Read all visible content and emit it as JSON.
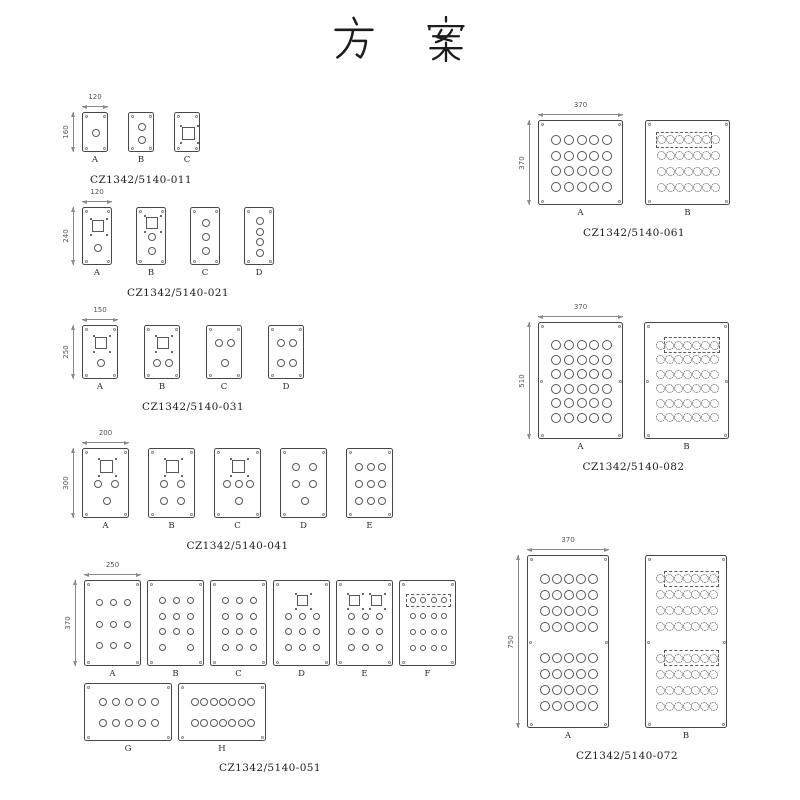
{
  "title": "方案",
  "title_chars": [
    "方",
    "案"
  ],
  "colors": {
    "line": "#474747",
    "hole": "#585858",
    "dim": "#8a8a8a",
    "text": "#1e1e1e"
  },
  "legend": {
    "o": "round-hole",
    "s": "square-cutout-with-corner-marks",
    ".": "empty-slot"
  },
  "groups": [
    {
      "code": "CZ1342/5140-011",
      "dim_w": "120",
      "dim_h": "160",
      "pos": {
        "left": 64,
        "top": 95
      },
      "pw": 26,
      "ph": 40,
      "gap": 20,
      "cs": 8,
      "sq": 13,
      "panel_rows": [
        [
          {
            "label": "A",
            "rows": [
              {
                "cells": "o"
              }
            ]
          },
          {
            "label": "B",
            "rows": [
              {
                "cells": "o"
              },
              {
                "cells": "o"
              }
            ]
          },
          {
            "label": "C",
            "rows": [
              {
                "cells": "s"
              }
            ]
          }
        ]
      ]
    },
    {
      "code": "CZ1342/5140-021",
      "dim_w": "120",
      "dim_h": "240",
      "pos": {
        "left": 64,
        "top": 190
      },
      "pw": 30,
      "ph": 58,
      "gap": 24,
      "cs": 8,
      "sq": 12,
      "panel_rows": [
        [
          {
            "label": "A",
            "rows": [
              {
                "cells": "s"
              },
              {
                "cells": "o"
              }
            ]
          },
          {
            "label": "B",
            "rows": [
              {
                "cells": "s"
              },
              {
                "cells": "o"
              },
              {
                "cells": "o"
              }
            ]
          },
          {
            "label": "C",
            "rows": [
              {
                "cells": "o"
              },
              {
                "cells": "o"
              },
              {
                "cells": "o"
              }
            ]
          },
          {
            "label": "D",
            "rows": [
              {
                "cells": "o"
              },
              {
                "cells": "o"
              },
              {
                "cells": "o"
              },
              {
                "cells": "o"
              }
            ]
          }
        ]
      ]
    },
    {
      "code": "CZ1342/5140-031",
      "dim_w": "150",
      "dim_h": "250",
      "pos": {
        "left": 64,
        "top": 308
      },
      "pw": 36,
      "ph": 54,
      "gap": 26,
      "cs": 8,
      "sq": 12,
      "panel_rows": [
        [
          {
            "label": "A",
            "rows": [
              {
                "cells": "s"
              },
              {
                "cells": "o"
              }
            ]
          },
          {
            "label": "B",
            "rows": [
              {
                "cells": "s"
              },
              {
                "cells": "oo"
              }
            ]
          },
          {
            "label": "C",
            "rows": [
              {
                "cells": "oo"
              },
              {
                "cells": "o"
              }
            ]
          },
          {
            "label": "D",
            "rows": [
              {
                "cells": "oo"
              },
              {
                "cells": "oo"
              }
            ]
          }
        ]
      ]
    },
    {
      "code": "CZ1342/5140-041",
      "dim_w": "200",
      "dim_h": "300",
      "pos": {
        "left": 64,
        "top": 431
      },
      "pw": 47,
      "ph": 70,
      "gap": 19,
      "cs": 8,
      "sq": 13,
      "panel_rows": [
        [
          {
            "label": "A",
            "rows": [
              {
                "cells": "s"
              },
              {
                "cells": "oo"
              },
              {
                "cells": "o"
              }
            ]
          },
          {
            "label": "B",
            "rows": [
              {
                "cells": "s"
              },
              {
                "cells": "oo"
              },
              {
                "cells": "oo"
              }
            ]
          },
          {
            "label": "C",
            "rows": [
              {
                "cells": "s"
              },
              {
                "cells": "ooo"
              },
              {
                "cells": "o"
              }
            ]
          },
          {
            "label": "D",
            "rows": [
              {
                "cells": "oo"
              },
              {
                "cells": "oo"
              },
              {
                "cells": "o"
              }
            ]
          },
          {
            "label": "E",
            "rows": [
              {
                "cells": "ooo"
              },
              {
                "cells": "ooo"
              },
              {
                "cells": "ooo"
              }
            ]
          }
        ]
      ]
    },
    {
      "code": "CZ1342/5140-051",
      "dim_w": "250",
      "dim_h": "370",
      "pos": {
        "left": 66,
        "top": 563
      },
      "pw": 57,
      "ph": 86,
      "gap": 6,
      "cs": 7,
      "sq": 11,
      "panel_rows": [
        [
          {
            "label": "A",
            "rows": [
              {
                "cells": "ooo"
              },
              {
                "cells": "ooo"
              },
              {
                "cells": "ooo"
              }
            ]
          },
          {
            "label": "B",
            "rows": [
              {
                "cells": "ooo"
              },
              {
                "cells": "ooo"
              },
              {
                "cells": "ooo"
              },
              {
                "cells": "o.o"
              }
            ]
          },
          {
            "label": "C",
            "rows": [
              {
                "cells": "ooo"
              },
              {
                "cells": "ooo"
              },
              {
                "cells": "ooo"
              },
              {
                "cells": "ooo"
              }
            ]
          },
          {
            "label": "D",
            "rows": [
              {
                "cells": "s"
              },
              {
                "cells": "ooo"
              },
              {
                "cells": "ooo"
              },
              {
                "cells": "ooo"
              }
            ]
          },
          {
            "label": "E",
            "rows": [
              {
                "cells": "ss"
              },
              {
                "cells": "ooo"
              },
              {
                "cells": "ooo"
              },
              {
                "cells": "ooo"
              }
            ]
          },
          {
            "label": "F",
            "cs": 6,
            "rows": [
              {
                "cells": "oooo",
                "box": [
                  0,
                  3
                ]
              },
              {
                "cells": "oooo"
              },
              {
                "cells": "oooo"
              },
              {
                "cells": "oooo"
              }
            ]
          }
        ],
        [
          {
            "label": "G",
            "w": 88,
            "h": 58,
            "cs": 8,
            "rows": [
              {
                "cells": "ooooo"
              },
              {
                "cells": "ooooo"
              }
            ]
          },
          {
            "label": "H",
            "w": 88,
            "h": 58,
            "cs": 8,
            "rows": [
              {
                "cells": "ooooooo"
              },
              {
                "cells": "ooooooo"
              }
            ]
          }
        ]
      ]
    },
    {
      "code": "CZ1342/5140-061",
      "dim_w": "370",
      "dim_h": "370",
      "pos": {
        "left": 520,
        "top": 103
      },
      "pw": 85,
      "ph": 85,
      "gap": 22,
      "cs": 10,
      "panel_rows": [
        [
          {
            "label": "A",
            "rows": [
              {
                "cells": "ooooo"
              },
              {
                "cells": "ooooo"
              },
              {
                "cells": "ooooo"
              },
              {
                "cells": "ooooo"
              }
            ]
          },
          {
            "label": "B",
            "cs": 9,
            "dc": true,
            "rows": [
              {
                "cells": "ooooooo",
                "box": [
                  0,
                  5
                ]
              },
              {
                "cells": "ooooooo"
              },
              {
                "cells": "ooooooo"
              },
              {
                "cells": "ooooooo"
              }
            ]
          }
        ]
      ]
    },
    {
      "code": "CZ1342/5140-082",
      "dim_w": "370",
      "dim_h": "510",
      "pos": {
        "left": 520,
        "top": 305
      },
      "pw": 85,
      "ph": 117,
      "gap": 21,
      "cs": 10,
      "mid": true,
      "panel_rows": [
        [
          {
            "label": "A",
            "rows": [
              {
                "cells": "ooooo"
              },
              {
                "cells": "ooooo"
              },
              {
                "cells": "ooooo"
              },
              {
                "cells": "ooooo"
              },
              {
                "cells": "ooooo"
              },
              {
                "cells": "ooooo"
              }
            ]
          },
          {
            "label": "B",
            "cs": 9,
            "dc": true,
            "rows": [
              {
                "cells": "ooooooo",
                "box": [
                  1,
                  6
                ]
              },
              {
                "cells": "ooooooo"
              },
              {
                "cells": "ooooooo"
              },
              {
                "cells": "ooooooo"
              },
              {
                "cells": "ooooooo"
              },
              {
                "cells": "ooooooo"
              }
            ]
          }
        ]
      ]
    },
    {
      "code": "CZ1342/5140-072",
      "dim_w": "370",
      "dim_h": "750",
      "pos": {
        "left": 509,
        "top": 538
      },
      "pw": 82,
      "ph": 173,
      "gap": 36,
      "cs": 10,
      "mid": true,
      "py": 15,
      "panel_rows": [
        [
          {
            "label": "A",
            "rows": [
              {
                "cells": "ooooo"
              },
              {
                "cells": "ooooo"
              },
              {
                "cells": "ooooo"
              },
              {
                "cells": "ooooo"
              },
              {
                "gap": true
              },
              {
                "cells": "ooooo"
              },
              {
                "cells": "ooooo"
              },
              {
                "cells": "ooooo"
              },
              {
                "cells": "ooooo"
              }
            ]
          },
          {
            "label": "B",
            "cs": 9,
            "dc": true,
            "rows": [
              {
                "cells": "ooooooo",
                "box": [
                  1,
                  6
                ]
              },
              {
                "cells": "ooooooo"
              },
              {
                "cells": "ooooooo"
              },
              {
                "cells": "ooooooo"
              },
              {
                "gap": true
              },
              {
                "cells": "ooooooo",
                "box": [
                  1,
                  6
                ]
              },
              {
                "cells": "ooooooo"
              },
              {
                "cells": "ooooooo"
              },
              {
                "cells": "ooooooo"
              }
            ]
          }
        ]
      ]
    }
  ]
}
